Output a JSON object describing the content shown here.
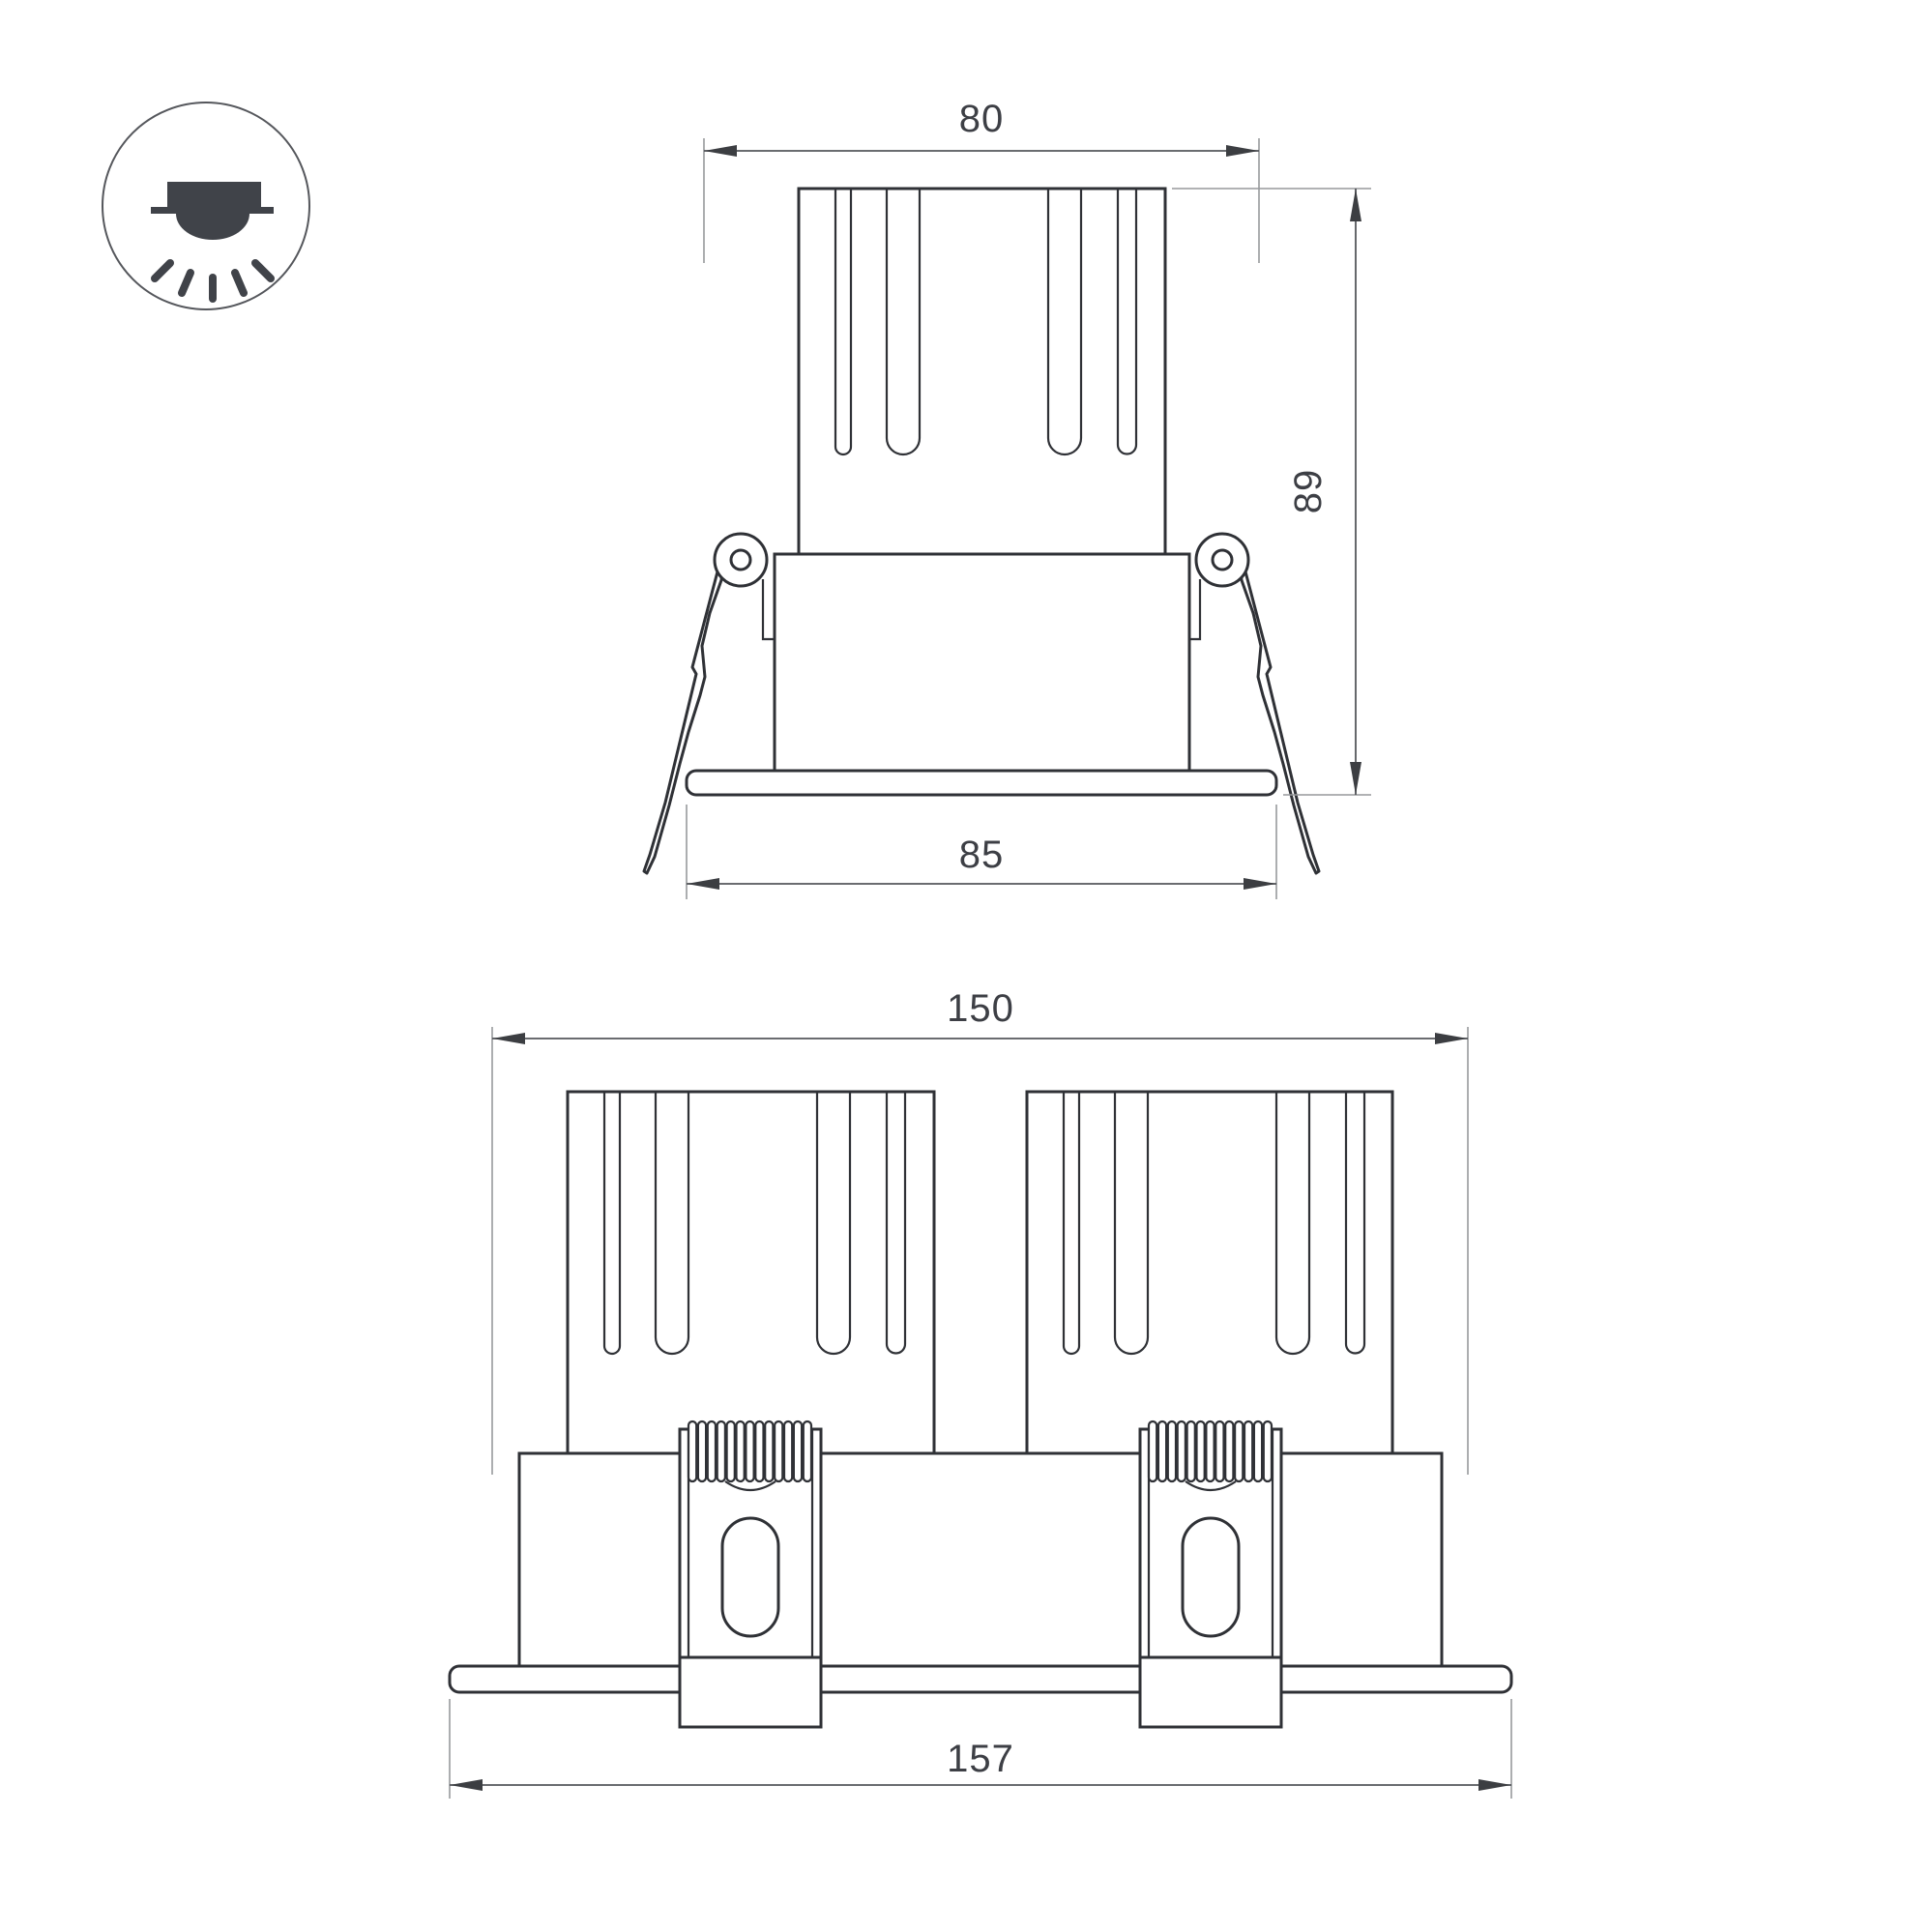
{
  "icon": {
    "name": "recessed-downlight-icon"
  },
  "colors": {
    "background": "#ffffff",
    "outline": "#2f3136",
    "dimension_line": "#55575c",
    "extension_line": "#97999c",
    "label_text": "#3d3f45",
    "icon": "#404349"
  },
  "views": {
    "single": {
      "name": "single-module-front-view",
      "dims": {
        "top_width": "80",
        "height": "89",
        "flange_width": "85"
      }
    },
    "double": {
      "name": "double-module-front-view",
      "dims": {
        "top_width": "150",
        "flange_width": "157"
      }
    }
  }
}
